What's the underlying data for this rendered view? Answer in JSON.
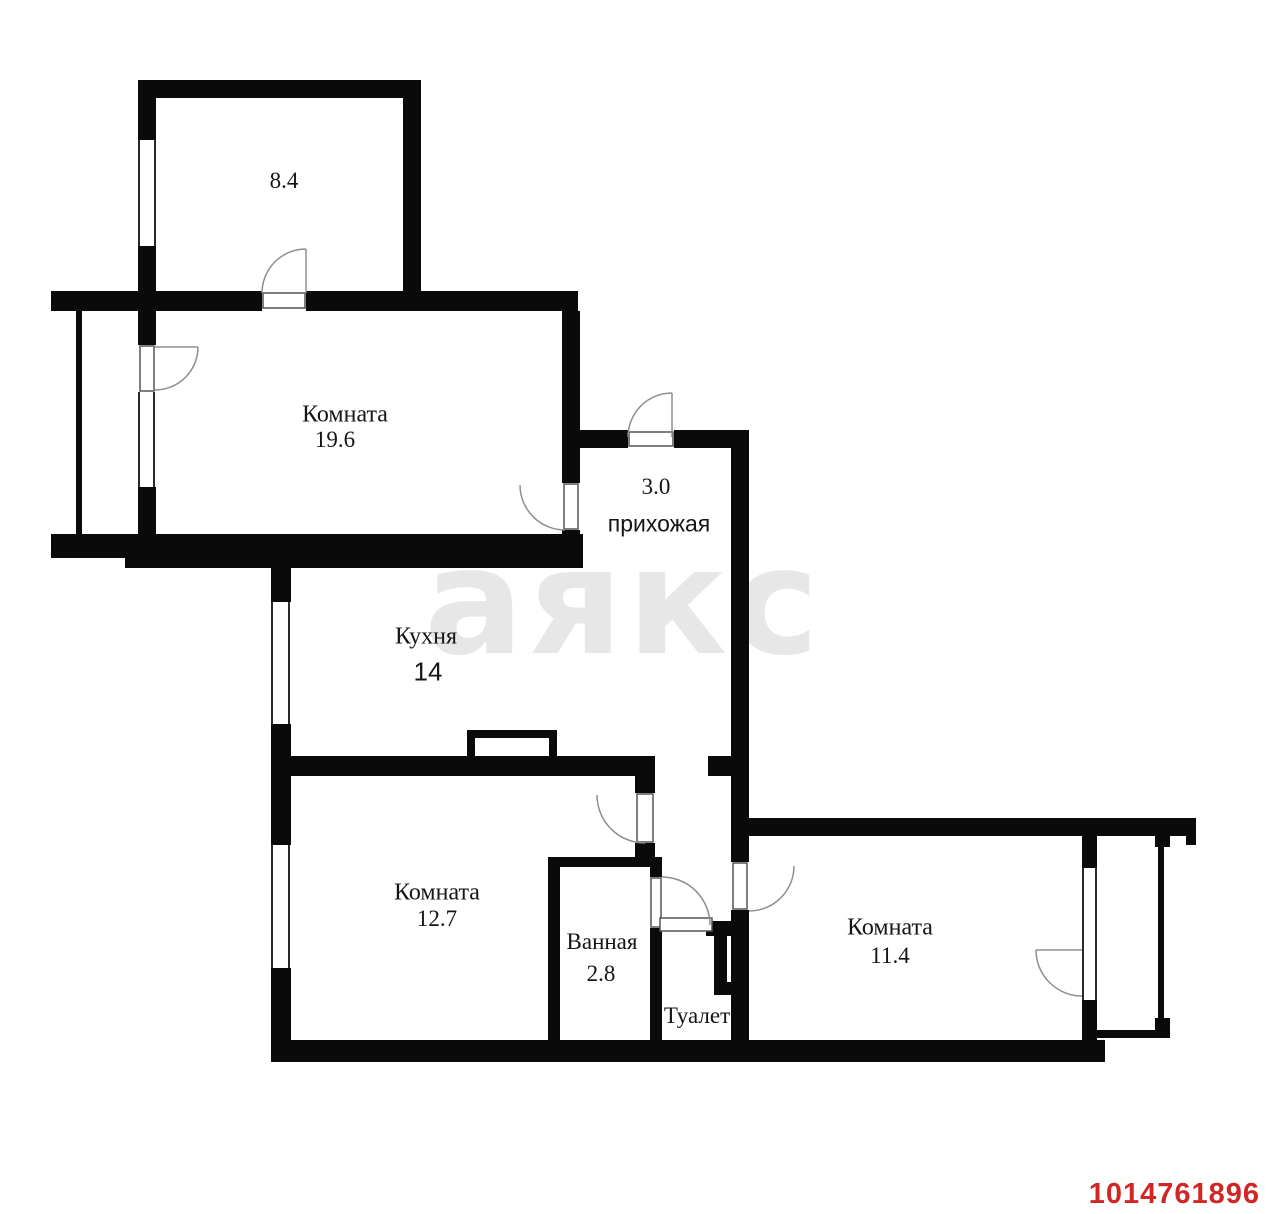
{
  "watermark": {
    "text": "аякс",
    "color": "#e7e7e7"
  },
  "listing_id": {
    "text": "1014761896",
    "color": "#d22626"
  },
  "rooms": {
    "r84": {
      "area": "8.4"
    },
    "r196": {
      "label": "Комната",
      "area": "19.6"
    },
    "hall": {
      "area": "3.0",
      "label": "прихожая"
    },
    "kitchen": {
      "label": "Кухня",
      "area": "14"
    },
    "r127": {
      "label": "Комната",
      "area": "12.7"
    },
    "bath": {
      "label": "Ванная",
      "area": "2.8"
    },
    "toilet": {
      "label": "Туалет"
    },
    "r114": {
      "label": "Комната",
      "area": "11.4"
    }
  },
  "colors": {
    "wall": "#0a0a0a",
    "door_arc": "#8f8f8f",
    "window_line": "#2a2a2a"
  }
}
